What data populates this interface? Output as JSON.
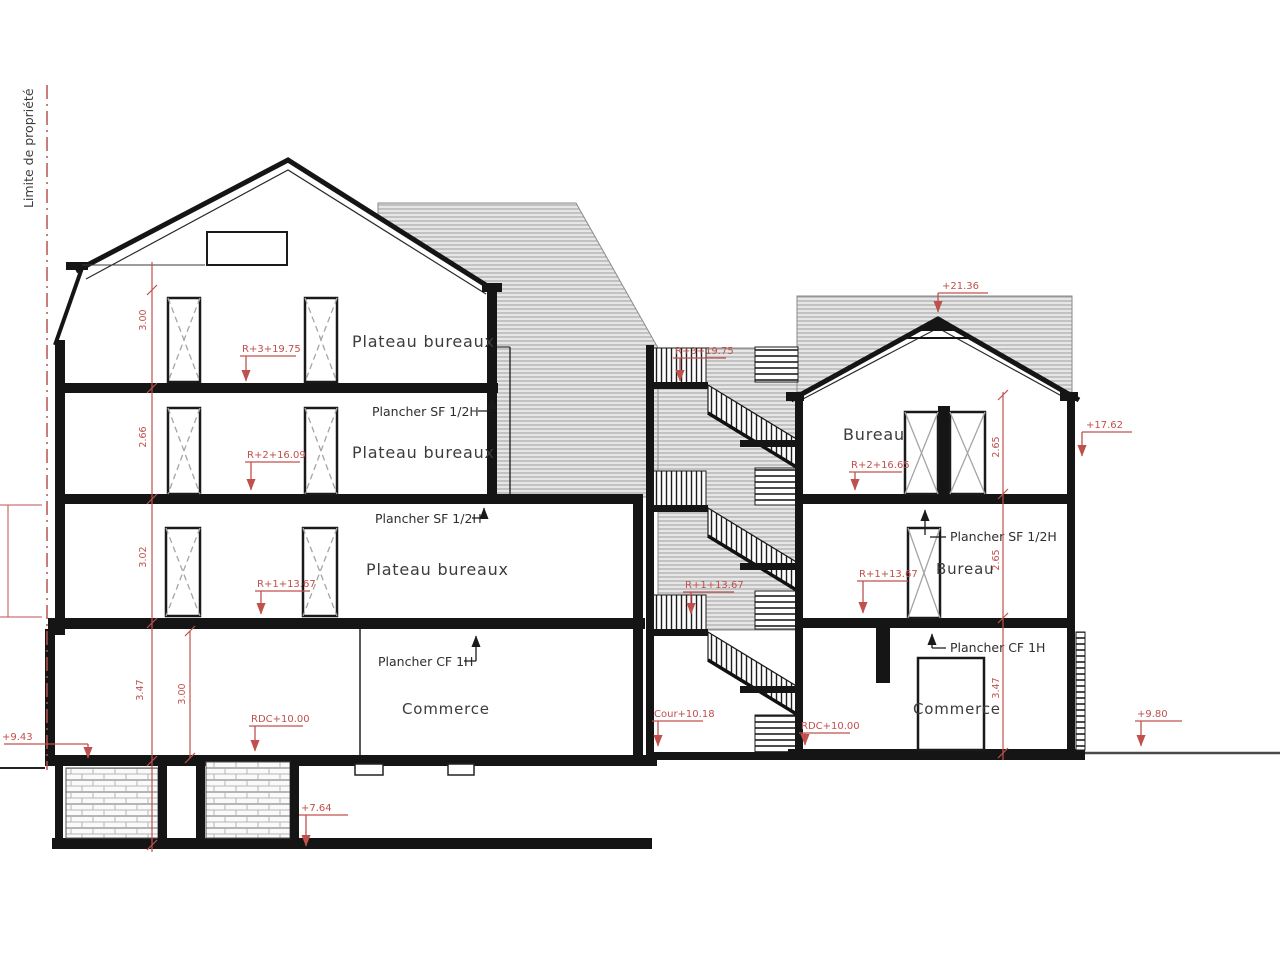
{
  "property_limit": "Limite de propriété",
  "left_building": {
    "floor3": {
      "room": "Plateau bureaux",
      "level": "R+3+19.75"
    },
    "floor2": {
      "room": "Plateau bureaux",
      "level": "R+2+16.09",
      "slab_note": "Plancher SF 1/2H"
    },
    "floor1": {
      "room": "Plateau bureaux",
      "level": "R+1+13.67",
      "slab_note": "Plancher SF 1/2H"
    },
    "ground": {
      "room": "Commerce",
      "level": "RDC+10.00",
      "slab_note": "Plancher CF 1H"
    },
    "terrain_level": "+9.43",
    "basement_level": "+7.64",
    "dims": [
      "3.00",
      "2.66",
      "3.02",
      "3.47"
    ],
    "ground_dim": "3.00"
  },
  "stairwell": {
    "top_level": "R+3+19.75",
    "mid_level": "R+1+13.67",
    "court_level": "Cour+10.18"
  },
  "right_building": {
    "ridge_level": "+21.36",
    "eaves_level": "+17.62",
    "floor2": {
      "room": "Bureau",
      "level": "R+2+16.65"
    },
    "floor1": {
      "room": "Bureau",
      "level": "R+1+13.67",
      "slab_note": "Plancher SF 1/2H"
    },
    "ground": {
      "room": "Commerce",
      "level": "RDC+10.00",
      "slab_note": "Plancher CF 1H"
    },
    "terrain_level": "+9.80",
    "dims": [
      "2.65",
      "2.65",
      "3.47"
    ]
  },
  "colors": {
    "annotation_red": "#c0504d",
    "linework_black": "#1a1a1a",
    "hatch_gray": "#e6e6e6",
    "text_gray": "#3c3c3c"
  }
}
